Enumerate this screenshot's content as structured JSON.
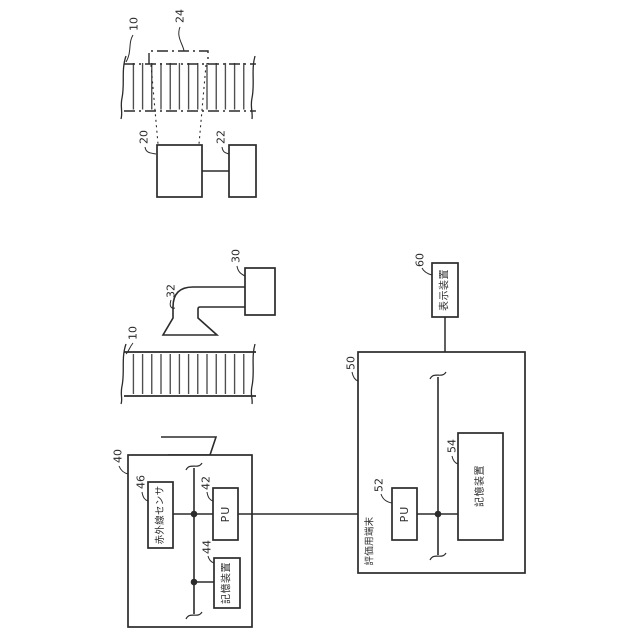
{
  "colors": {
    "background": "#ffffff",
    "line": "#2b2b2b"
  },
  "camera_assembly": {
    "road_label": "10",
    "capture_region_label": "24",
    "camera_label": "20",
    "controller_label": "22"
  },
  "lamp_assembly": {
    "lamp_label": "30",
    "arm_label": "32",
    "road_label": "10"
  },
  "sensor_unit": {
    "unit_label": "40",
    "ir_sensor_label": "46",
    "ir_sensor_text": "赤外線センサ",
    "pu_label": "42",
    "pu_text": "PU",
    "storage_label": "44",
    "storage_text": "記憶装置"
  },
  "terminal": {
    "unit_label": "50",
    "title": "評価用端末",
    "pu_label": "52",
    "pu_text": "PU",
    "storage_label": "54",
    "storage_text": "記憶装置"
  },
  "display": {
    "unit_label": "60",
    "text": "表示装置"
  }
}
